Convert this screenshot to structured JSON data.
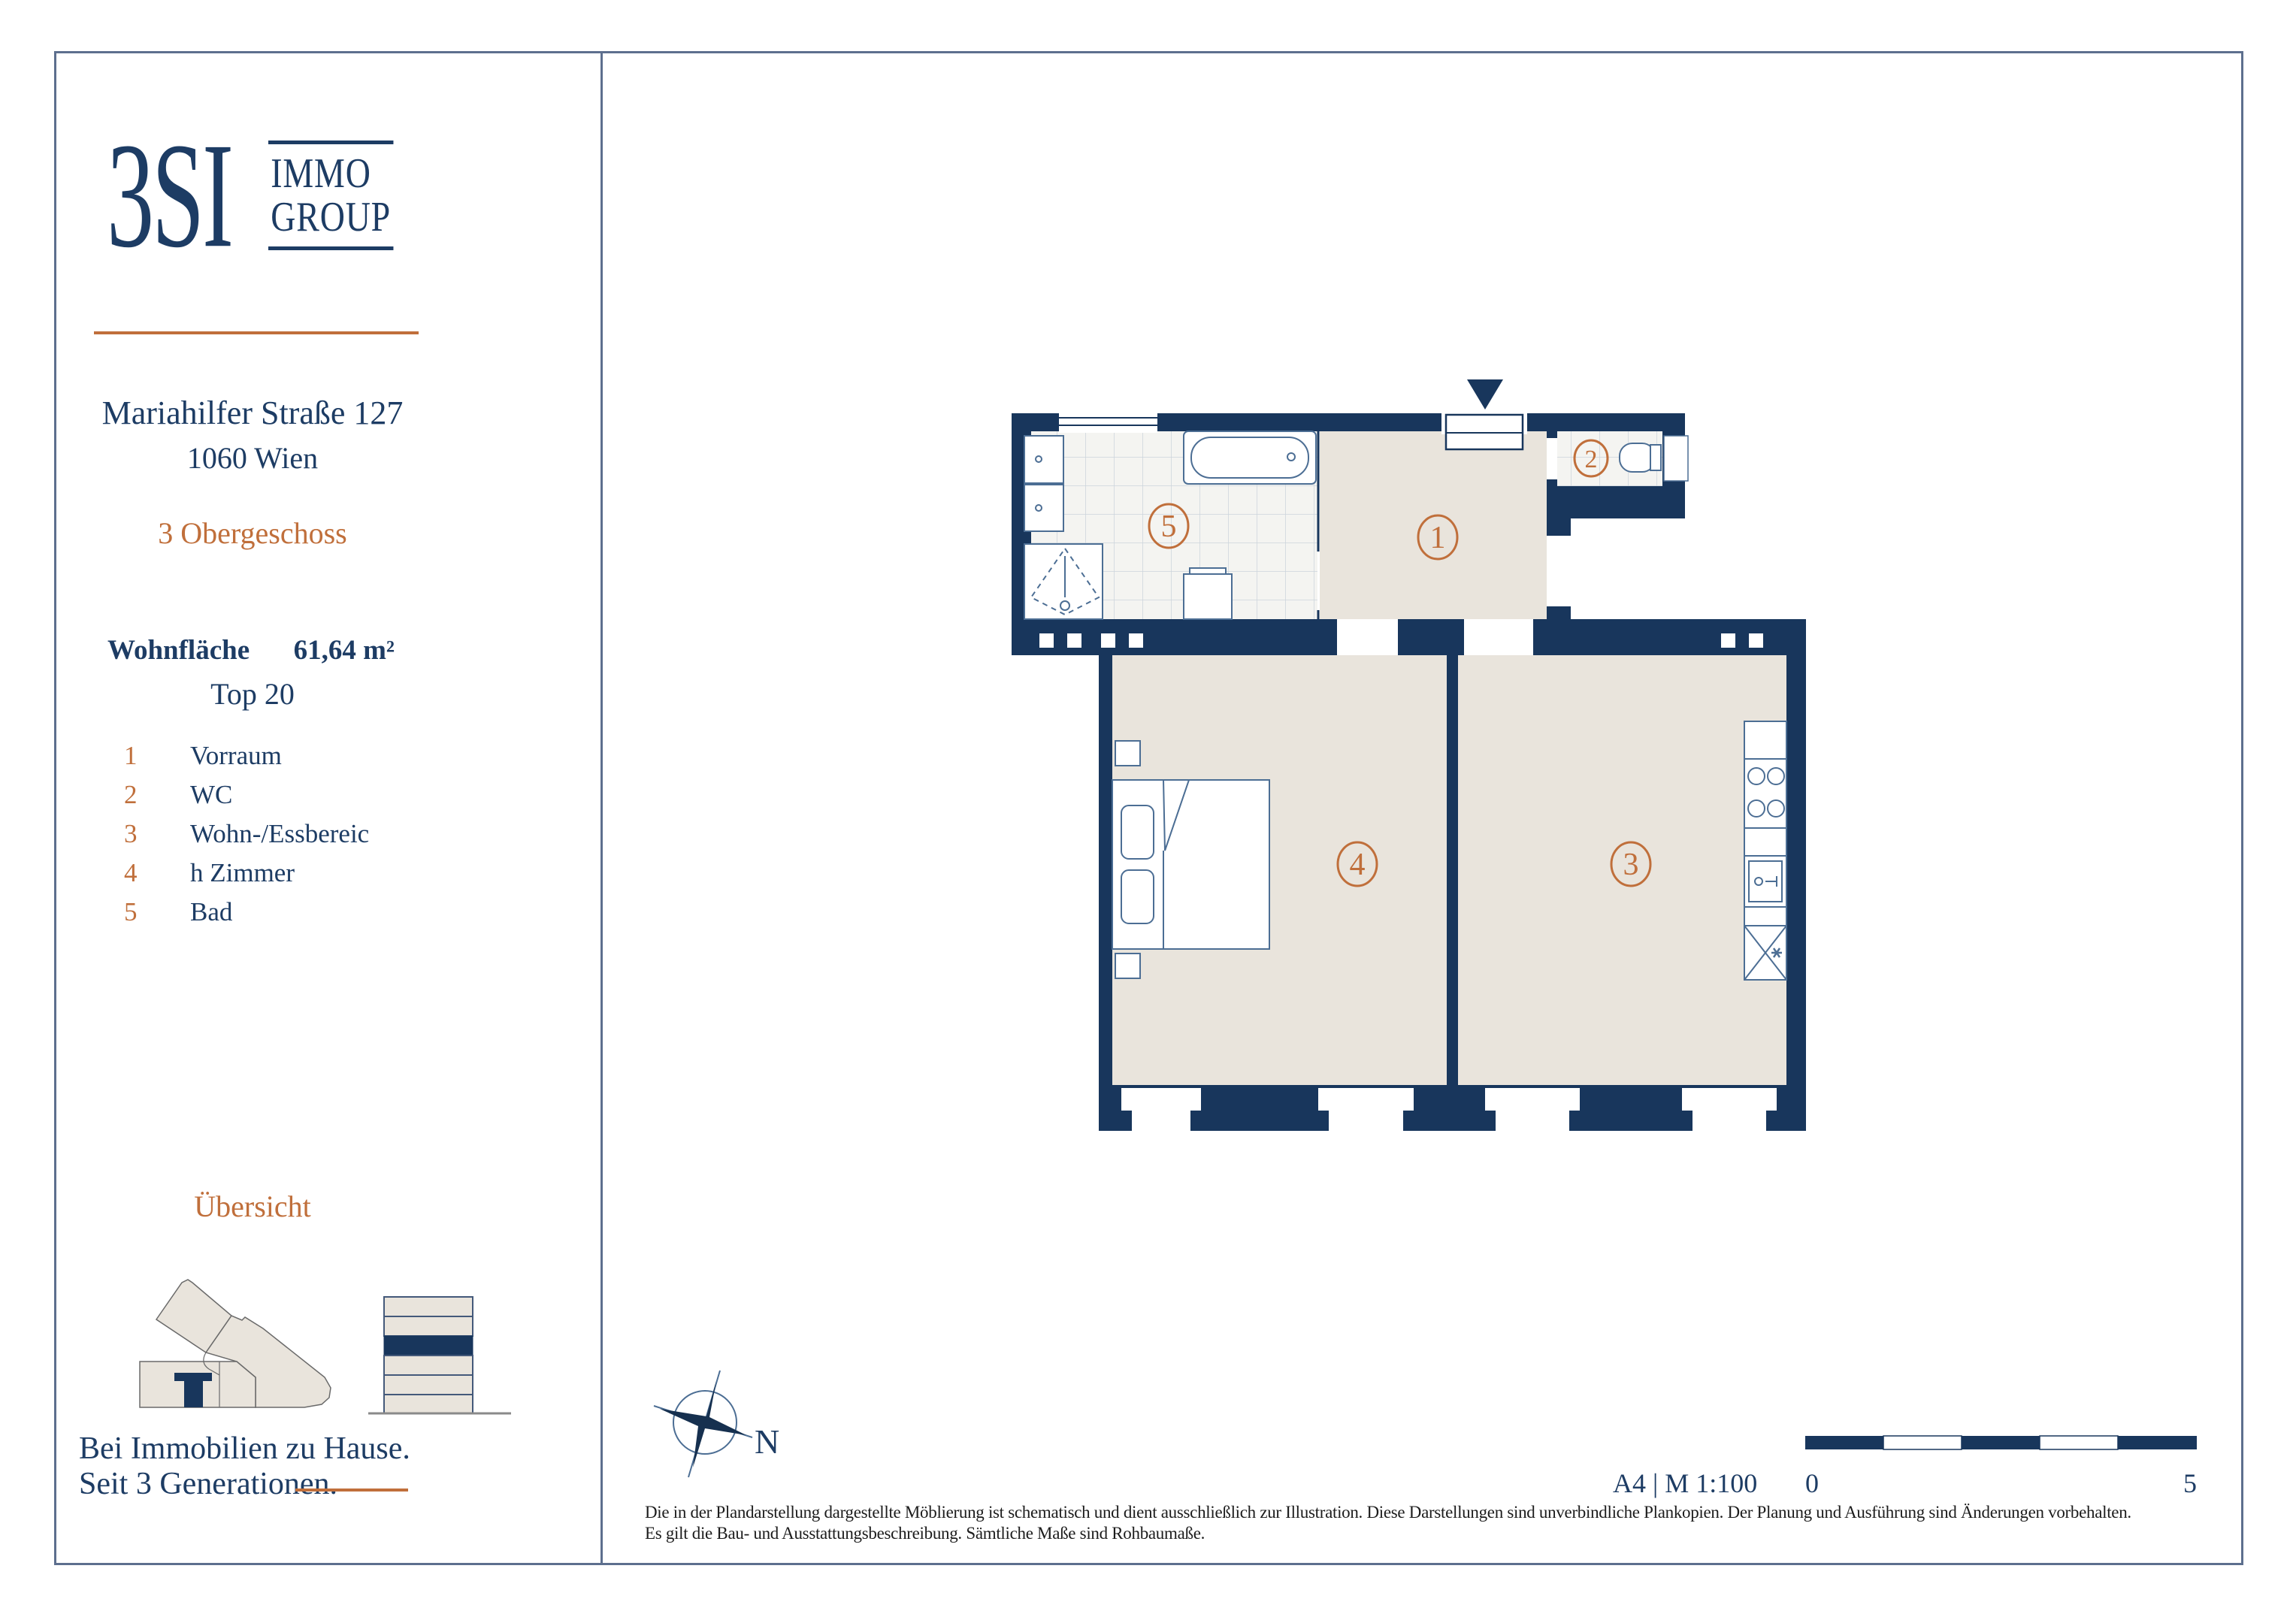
{
  "sidebar": {
    "logo": {
      "mark": "3SI",
      "line1": "IMMO",
      "line2": "GROUP"
    },
    "address_line1": "Mariahilfer Straße 127",
    "address_line2": "1060 Wien",
    "floor": "3 Obergeschoss",
    "area_label": "Wohnfläche",
    "area_value": "61,64 m²",
    "unit": "Top 20",
    "legend": [
      {
        "num": "1",
        "label": "Vorraum"
      },
      {
        "num": "2",
        "label": "WC"
      },
      {
        "num": "3",
        "label": "Wohn-/Essbereic"
      },
      {
        "num": "4",
        "label": "h Zimmer"
      },
      {
        "num": "5",
        "label": "Bad"
      }
    ],
    "overview_title": "Übersicht",
    "tagline_line1": "Bei Immobilien zu Hause.",
    "tagline_line2": "Seit 3 Generationen."
  },
  "plan": {
    "rooms": [
      {
        "number": "1"
      },
      {
        "number": "2"
      },
      {
        "number": "3"
      },
      {
        "number": "4"
      },
      {
        "number": "5"
      }
    ],
    "compass_label": "N"
  },
  "footer": {
    "format_scale": "A4 | M 1:100",
    "scale_start": "0",
    "scale_end": "5",
    "disclaimer_line1": "Die in der Plandarstellung dargestellte Möblierung ist schematisch und dient ausschließlich zur Illustration. Diese Darstellungen sind unverbindliche Plankopien. Der Planung und Ausführung sind Änderungen vorbehalten.",
    "disclaimer_line2": "Es gilt die Bau- und Ausstattungsbeschreibung. Sämtliche Maße sind Rohbaumaße."
  },
  "colors": {
    "navy_wall": "#18365c",
    "navy_text": "#1d3c64",
    "orange_accent": "#c06f3b",
    "floor_beige": "#e9e4dc",
    "tile_line": "#ccd4dc",
    "furniture_stroke": "#4c6e94"
  }
}
